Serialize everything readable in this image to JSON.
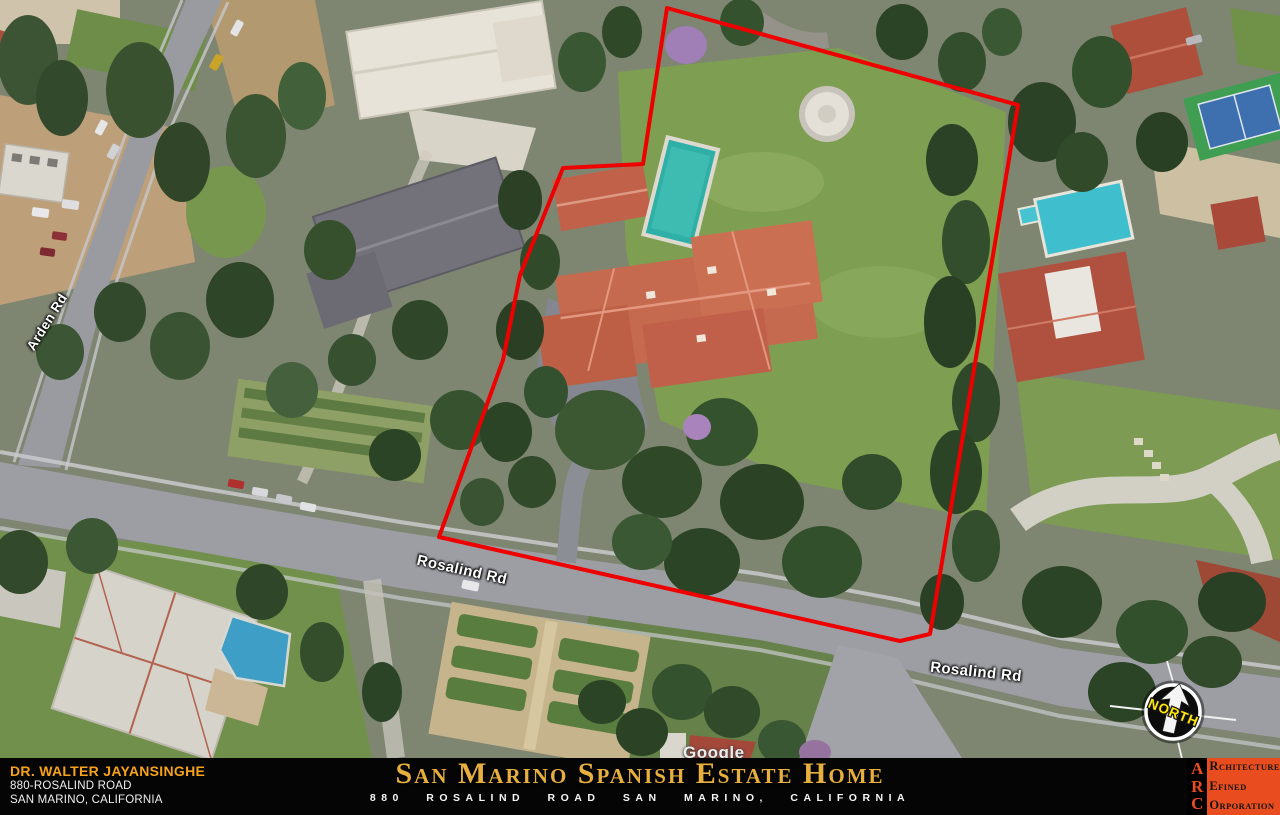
{
  "map": {
    "street_labels": [
      {
        "text": "Rosalind Rd"
      },
      {
        "text": "Rosalind Rd"
      },
      {
        "text": "Arden Rd"
      }
    ],
    "watermark": "Google",
    "compass": {
      "label": "NORTH",
      "label_color": "#ffe80a"
    },
    "boundary": {
      "color": "#ee0000",
      "points": [
        [
          667,
          8
        ],
        [
          1018,
          105
        ],
        [
          930,
          634
        ],
        [
          900,
          641
        ],
        [
          439,
          537
        ],
        [
          503,
          360
        ],
        [
          520,
          275
        ],
        [
          563,
          168
        ],
        [
          643,
          164
        ]
      ]
    }
  },
  "footer": {
    "client": {
      "name": "DR. WALTER JAYANSINGHE",
      "address_line1": "880-ROSALIND ROAD",
      "address_line2": "SAN MARINO, CALIFORNIA",
      "name_color": "#f6a21a"
    },
    "title": "San Marino Spanish Estate Home",
    "title_color": "#e6af3e",
    "subtitle": "880 ROSALIND ROAD SAN MARINO, CALIFORNIA",
    "logo": {
      "initials": [
        "A",
        "R",
        "C"
      ],
      "words": [
        {
          "lead": "R",
          "rest": "CHITECTURE"
        },
        {
          "lead": "E",
          "rest": "FINED"
        },
        {
          "lead": "O",
          "rest": "RPORATION"
        }
      ],
      "accent_color": "#e94d1f"
    }
  }
}
